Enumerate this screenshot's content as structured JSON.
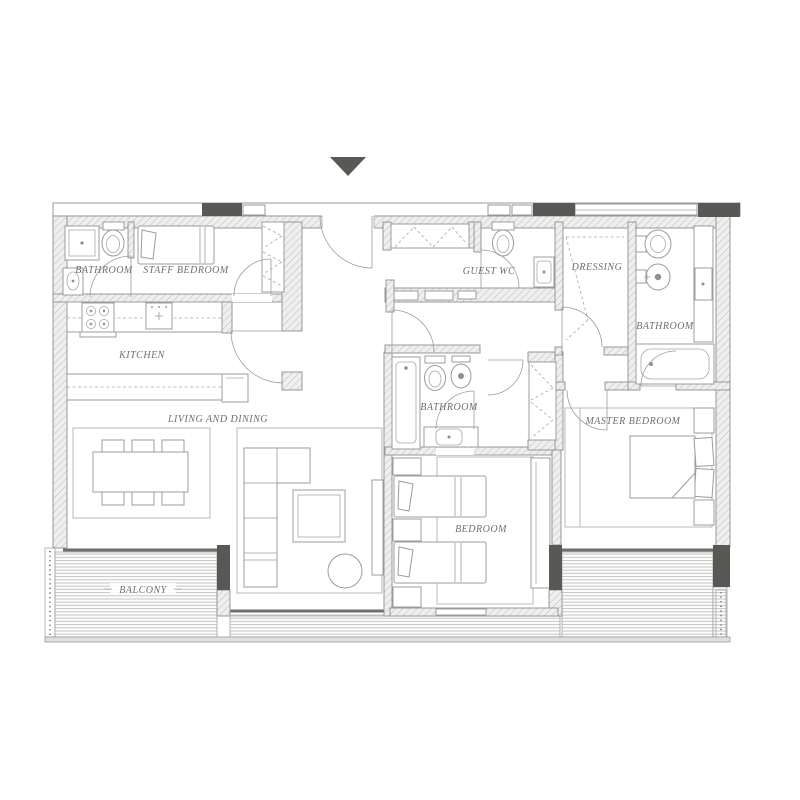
{
  "plan": {
    "title": "Apartment Floor Plan",
    "entrance_marker": "entrance",
    "rooms": {
      "bathroom_left": {
        "label": "BATHROOM"
      },
      "staff_bedroom": {
        "label": "STAFF BEDROOM"
      },
      "kitchen": {
        "label": "KITCHEN"
      },
      "living_dining": {
        "label": "LIVING AND DINING"
      },
      "balcony": {
        "label": "BALCONY"
      },
      "guest_wc": {
        "label": "GUEST WC"
      },
      "dressing": {
        "label": "DRESSING"
      },
      "bathroom_middle": {
        "label": "BATHROOM"
      },
      "bedroom": {
        "label": "BEDROOM"
      },
      "bathroom_master": {
        "label": "BATHROOM"
      },
      "master_bedroom": {
        "label": "MASTER BEDROOM"
      }
    },
    "colors": {
      "dark_fill": "#5a5855",
      "wall_line": "#8f8f8f",
      "text": "#6e6e6e",
      "background": "#ffffff"
    }
  }
}
